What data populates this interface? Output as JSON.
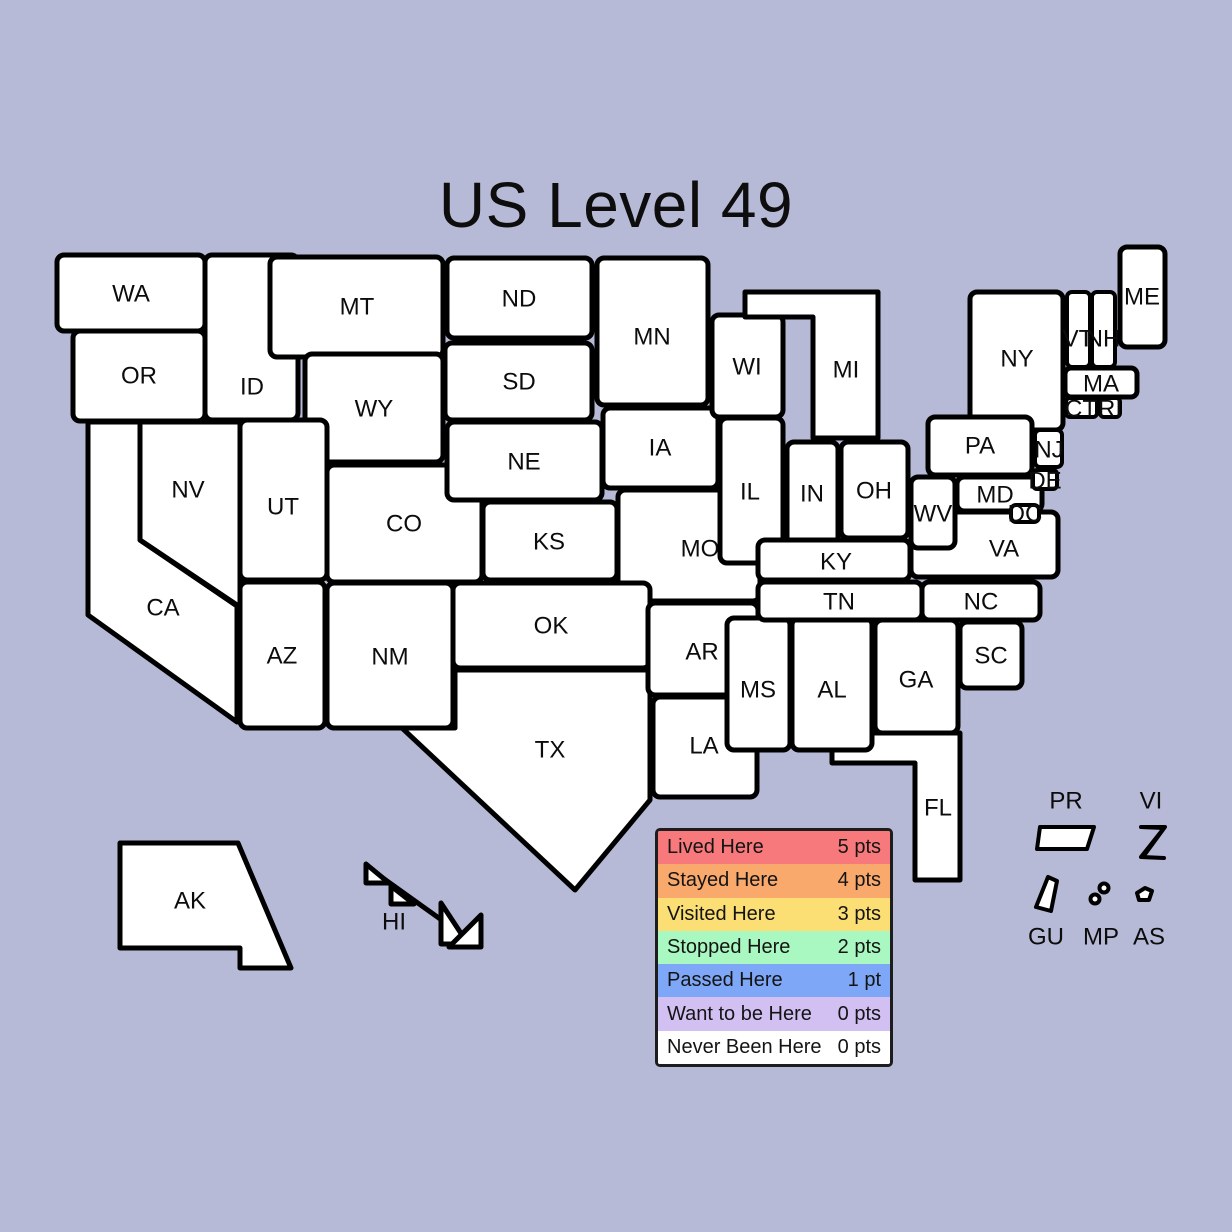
{
  "title": "US Level 49",
  "background": "#b6bad6",
  "border_color": "#000000",
  "status_colors": {
    "lived": "#f8797c",
    "stayed": "#f9a96b",
    "visited": "#fbdf75",
    "stopped": "#aaf8c1",
    "passed": "#7fa7f7",
    "want": "#d2c0f2",
    "never": "#ffffff"
  },
  "legend": {
    "rows": [
      {
        "label": "Lived Here",
        "points": "5 pts",
        "status": "lived"
      },
      {
        "label": "Stayed Here",
        "points": "4 pts",
        "status": "stayed"
      },
      {
        "label": "Visited Here",
        "points": "3 pts",
        "status": "visited"
      },
      {
        "label": "Stopped Here",
        "points": "2 pts",
        "status": "stopped"
      },
      {
        "label": "Passed Here",
        "points": "1 pt",
        "status": "passed"
      },
      {
        "label": "Want to be Here",
        "points": "0 pts",
        "status": "want"
      },
      {
        "label": "Never Been Here",
        "points": "0 pts",
        "status": "never"
      }
    ]
  },
  "states": {
    "WA": {
      "label": "WA",
      "status": "never"
    },
    "OR": {
      "label": "OR",
      "status": "never"
    },
    "ID": {
      "label": "ID",
      "status": "never"
    },
    "MT": {
      "label": "MT",
      "status": "never"
    },
    "WY": {
      "label": "WY",
      "status": "never"
    },
    "ND": {
      "label": "ND",
      "status": "never"
    },
    "SD": {
      "label": "SD",
      "status": "never"
    },
    "MN": {
      "label": "MN",
      "status": "never"
    },
    "NE": {
      "label": "NE",
      "status": "never"
    },
    "KS": {
      "label": "KS",
      "status": "never"
    },
    "IA": {
      "label": "IA",
      "status": "never"
    },
    "MO": {
      "label": "MO",
      "status": "never"
    },
    "WI": {
      "label": "WI",
      "status": "never"
    },
    "IL": {
      "label": "IL",
      "status": "never"
    },
    "IN": {
      "label": "IN",
      "status": "never"
    },
    "OH": {
      "label": "OH",
      "status": "never"
    },
    "MI": {
      "label": "MI",
      "status": "never"
    },
    "UT": {
      "label": "UT",
      "status": "never"
    },
    "CO": {
      "label": "CO",
      "status": "stopped"
    },
    "AZ": {
      "label": "AZ",
      "status": "visited"
    },
    "NM": {
      "label": "NM",
      "status": "never"
    },
    "OK": {
      "label": "OK",
      "status": "never"
    },
    "TX": {
      "label": "TX",
      "status": "stayed"
    },
    "AR": {
      "label": "AR",
      "status": "stopped"
    },
    "LA": {
      "label": "LA",
      "status": "never"
    },
    "MS": {
      "label": "MS",
      "status": "never"
    },
    "AL": {
      "label": "AL",
      "status": "never"
    },
    "GA": {
      "label": "GA",
      "status": "stopped"
    },
    "SC": {
      "label": "SC",
      "status": "stayed"
    },
    "FL": {
      "label": "FL",
      "status": "stayed"
    },
    "KY": {
      "label": "KY",
      "status": "stayed"
    },
    "TN": {
      "label": "TN",
      "status": "stayed"
    },
    "NC": {
      "label": "NC",
      "status": "passed"
    },
    "VA": {
      "label": "VA",
      "status": "passed"
    },
    "WV": {
      "label": "WV",
      "status": "never"
    },
    "MD": {
      "label": "MD",
      "status": "passed"
    },
    "DE": {
      "label": "DE",
      "status": "never"
    },
    "NJ": {
      "label": "NJ",
      "status": "passed"
    },
    "DC": {
      "label": "DC",
      "status": "stayed"
    },
    "PA": {
      "label": "PA",
      "status": "never"
    },
    "NY": {
      "label": "NY",
      "status": "stayed"
    },
    "VT": {
      "label": "VT",
      "status": "never"
    },
    "NH": {
      "label": "NH",
      "status": "never"
    },
    "ME": {
      "label": "ME",
      "status": "never"
    },
    "MA": {
      "label": "MA",
      "status": "never"
    },
    "CT": {
      "label": "CT",
      "status": "never"
    },
    "RI": {
      "label": "RI",
      "status": "never"
    },
    "CA": {
      "label": "CA",
      "status": "stayed"
    },
    "NV": {
      "label": "NV",
      "status": "stayed"
    },
    "AK": {
      "label": "AK",
      "status": "never"
    },
    "HI": {
      "label": "HI",
      "status": "never"
    },
    "PR": {
      "label": "PR",
      "status": "never"
    },
    "VI": {
      "label": "VI",
      "status": "never"
    },
    "GU": {
      "label": "GU",
      "status": "never"
    },
    "MP": {
      "label": "MP",
      "status": "never"
    },
    "AS": {
      "label": "AS",
      "status": "never"
    }
  }
}
